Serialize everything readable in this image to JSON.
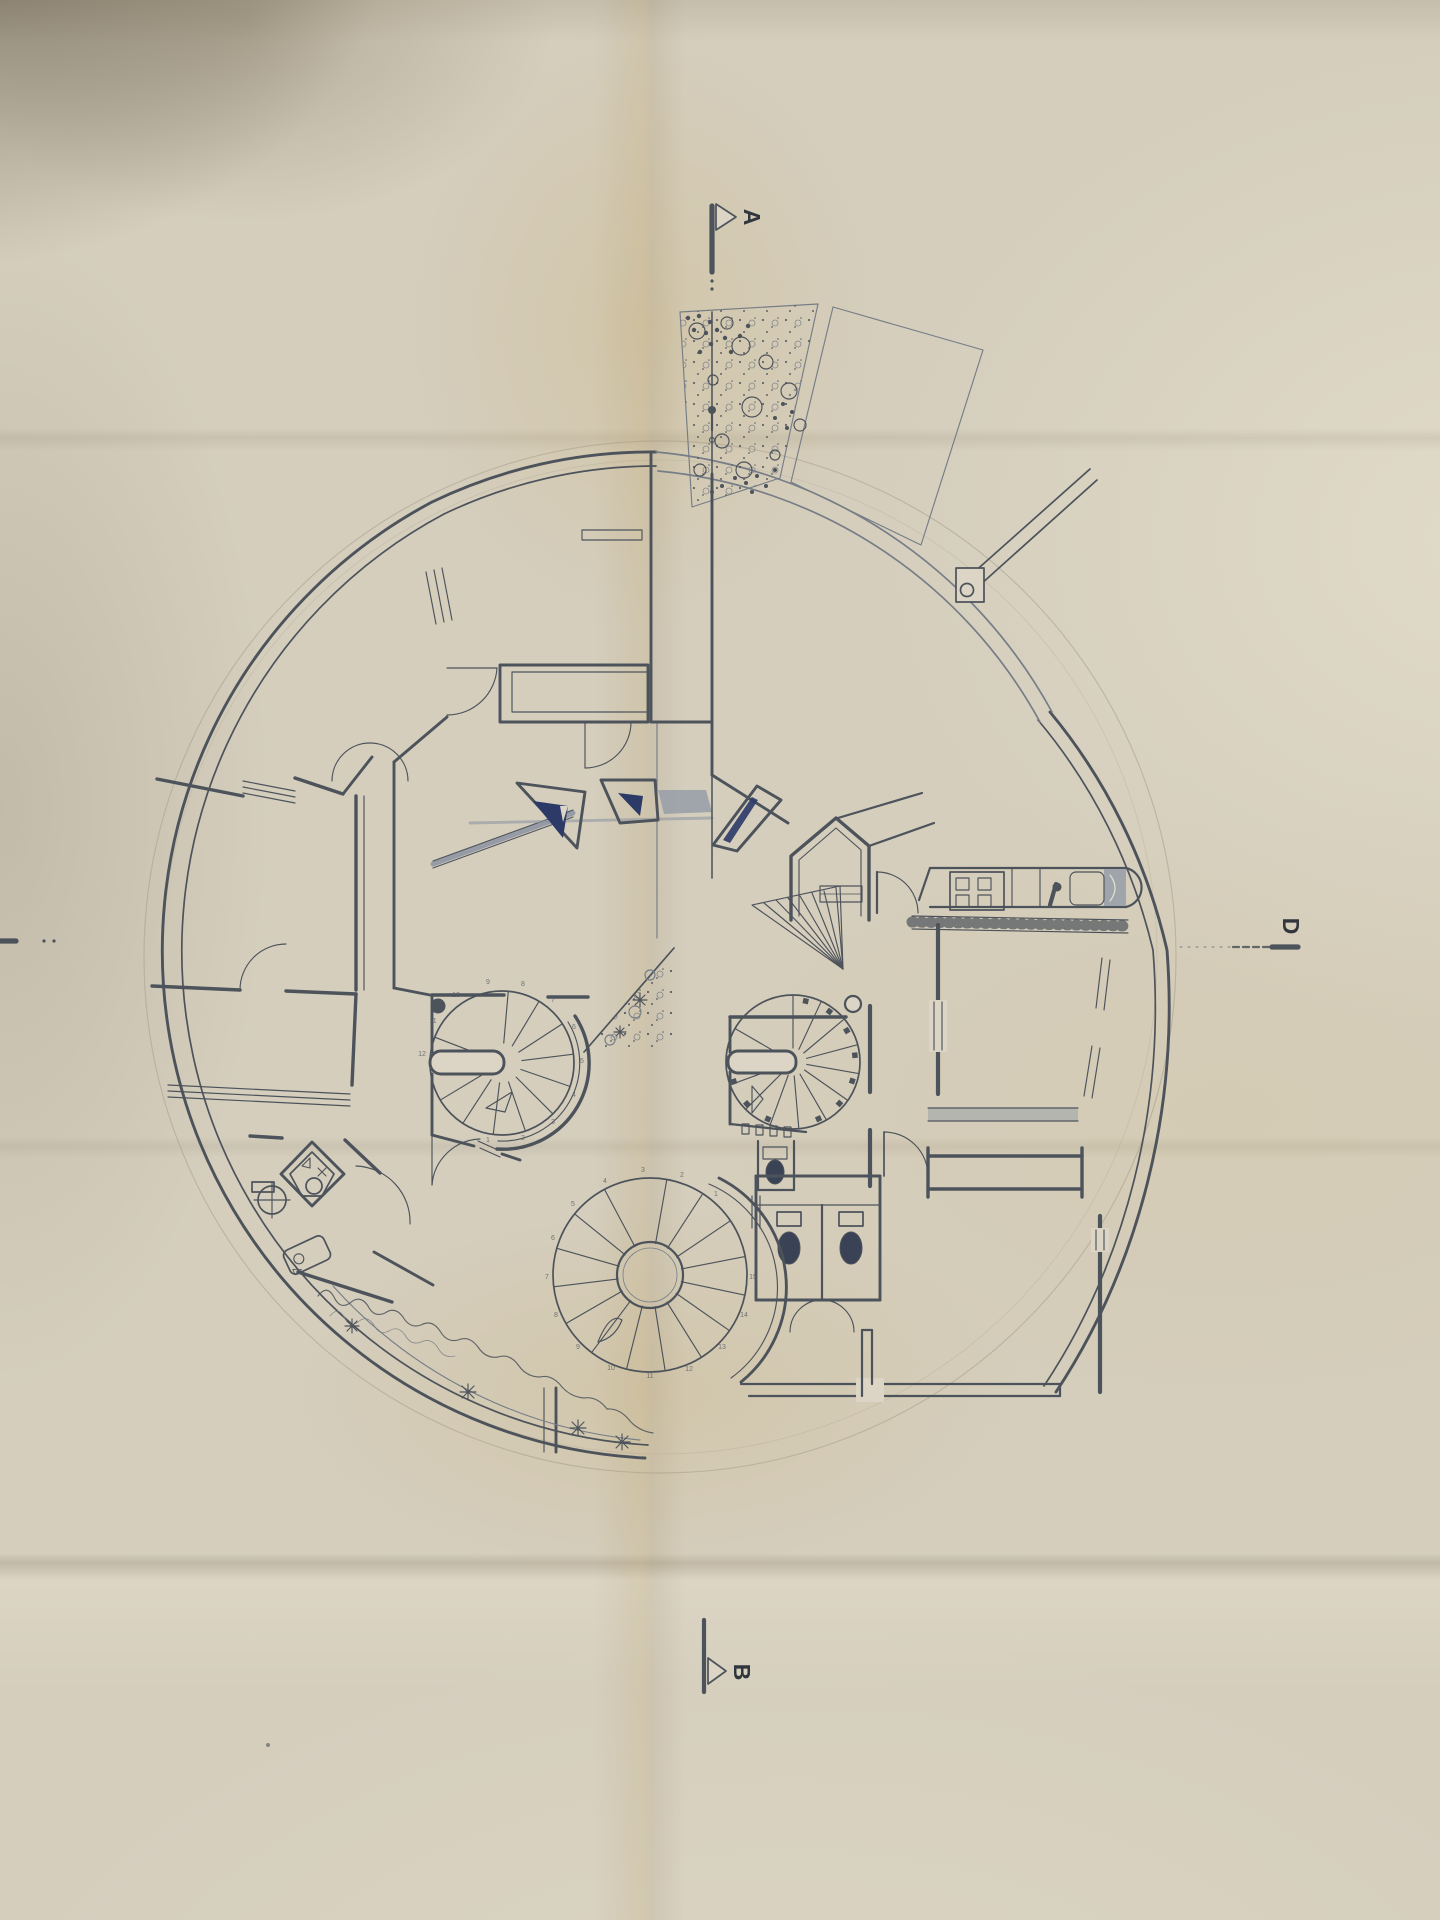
{
  "drawing": {
    "section_markers": {
      "a": "A",
      "b": "B",
      "d": "D"
    },
    "stairs": {
      "left_spiral_steps": [
        "1",
        "2",
        "3",
        "4",
        "5",
        "6",
        "7",
        "8",
        "9",
        "10",
        "11",
        "12"
      ],
      "bottom_spiral_steps": [
        "1",
        "2",
        "3",
        "4",
        "5",
        "6",
        "7",
        "8",
        "9",
        "10",
        "11",
        "12",
        "13",
        "14",
        "15"
      ]
    },
    "colors": {
      "ink": "#4d535b",
      "skylight_navy": "#2c3a68",
      "counter_gray": "#969da8",
      "paper": "#d5cebd"
    }
  }
}
